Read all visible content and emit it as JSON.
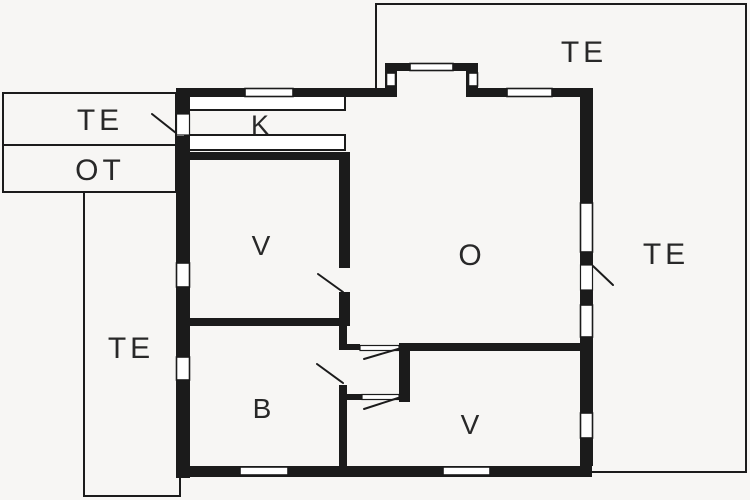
{
  "plan": {
    "colors": {
      "bg": "#f7f6f4",
      "wall": "#1b1b1b",
      "opening": "#ffffff",
      "ink": "#282828"
    },
    "labels": {
      "te_porch": "TE",
      "ot_utility": "OT",
      "te_left_terrace": "TE",
      "te_top_right_terrace": "TE",
      "te_right_terrace": "TE",
      "kitchen": "K",
      "bedroom_upper": "V",
      "living_room": "O",
      "bathroom": "B",
      "bedroom_lower": "V"
    }
  }
}
